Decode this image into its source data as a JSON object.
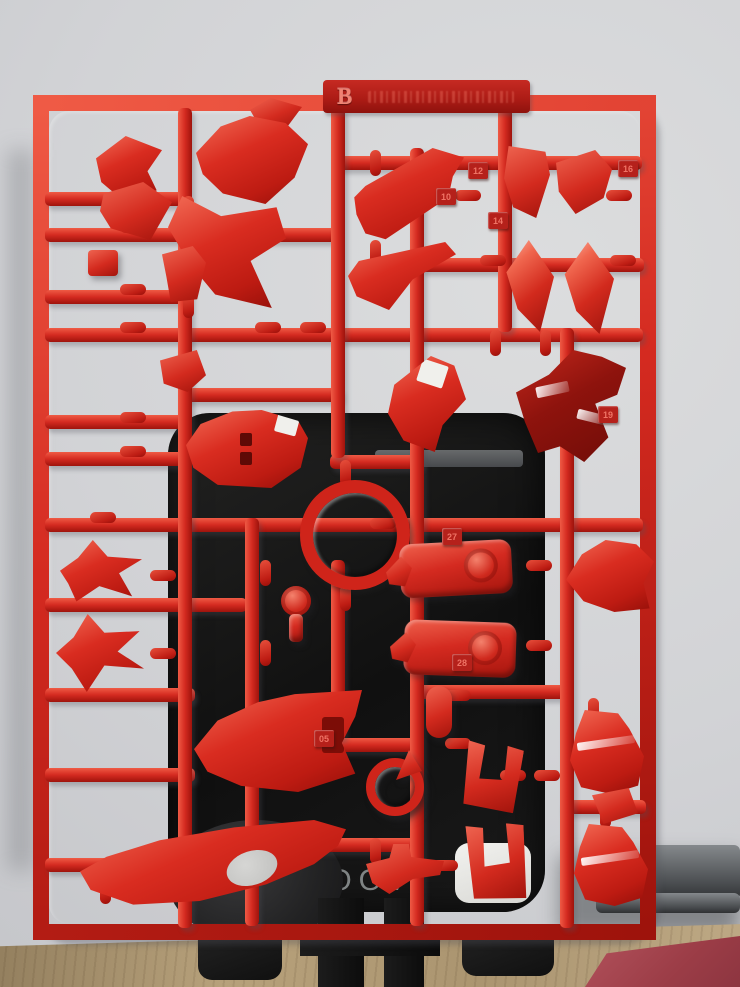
{
  "colors": {
    "sprue_red": "#d42a20",
    "sprue_red_dark": "#9e130c",
    "sprue_red_light": "#ef5a45",
    "label_red": "#b5211b",
    "stand_black": "#141414",
    "wall_gray": "#d2d3d6",
    "desk_wood": "#b29b75",
    "cloth_red": "#a8454f",
    "logo_gray": "#9aa0a1"
  },
  "runner": {
    "letter": "B",
    "part_tags": [
      {
        "label": "16"
      },
      {
        "label": "12"
      },
      {
        "label": "10"
      },
      {
        "label": "14"
      },
      {
        "label": "19"
      },
      {
        "label": "27"
      },
      {
        "label": "28"
      },
      {
        "label": "05"
      }
    ]
  },
  "stand": {
    "logo_text": "QOOvi"
  }
}
